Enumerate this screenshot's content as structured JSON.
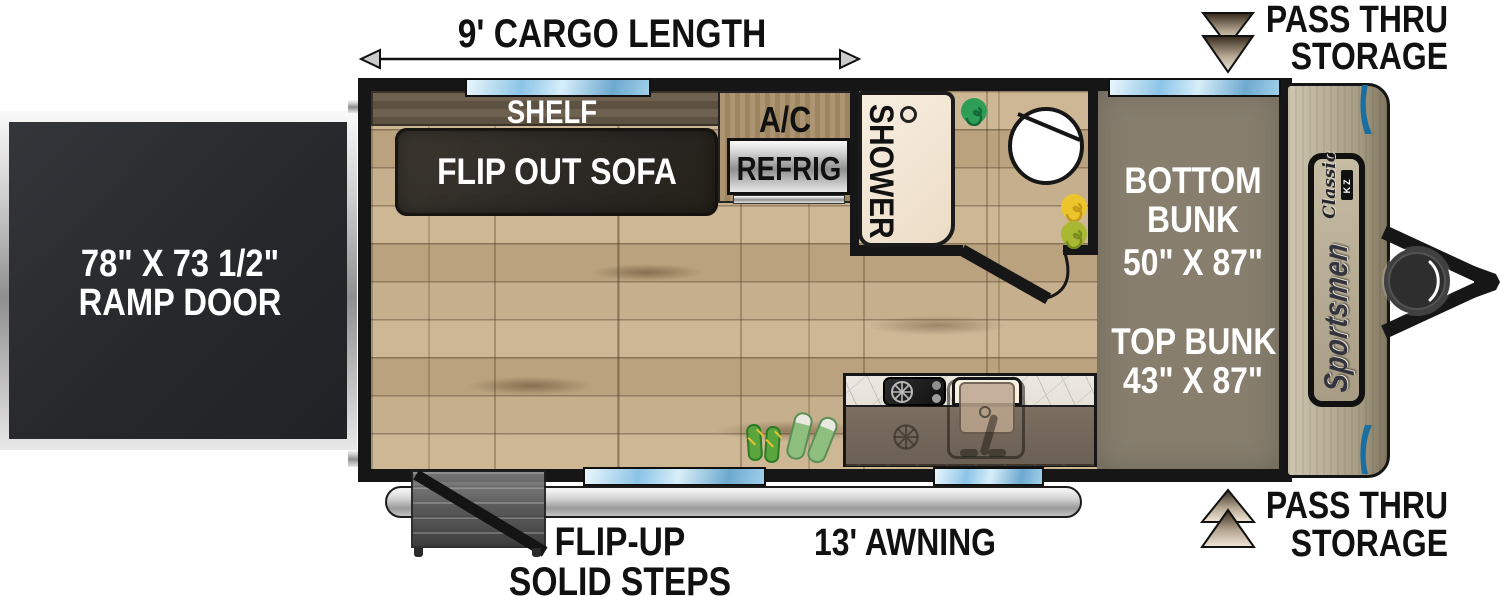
{
  "annotations": {
    "cargo_length": "9' CARGO LENGTH",
    "ramp_door_line1": "78\" X 73 1/2\"",
    "ramp_door_line2": "RAMP DOOR",
    "pass_thru_line1": "PASS THRU",
    "pass_thru_line2": "STORAGE",
    "steps_line1": "FLIP-UP",
    "steps_line2": "SOLID STEPS",
    "awning": "13' AWNING"
  },
  "furniture": {
    "shelf": "SHELF",
    "sofa": "FLIP OUT SOFA",
    "ac": "A/C",
    "refrig": "REFRIG",
    "shower": "SHOWER",
    "bottom_bunk": [
      "BOTTOM",
      "BUNK",
      "50\" X 87\""
    ],
    "top_bunk": [
      "TOP BUNK",
      "43\" X 87\""
    ]
  },
  "brand": {
    "name": "Sportsmen",
    "series": "Classic",
    "maker": "KZ"
  },
  "colors": {
    "window_blue": "#8cc4e6",
    "bunk_taupe": "#877e6e",
    "cap_tan": "#b4aa93",
    "floor_wood": "#c3ad8c",
    "accent_blue": "#1b6fa0",
    "wall_black": "#161616"
  }
}
